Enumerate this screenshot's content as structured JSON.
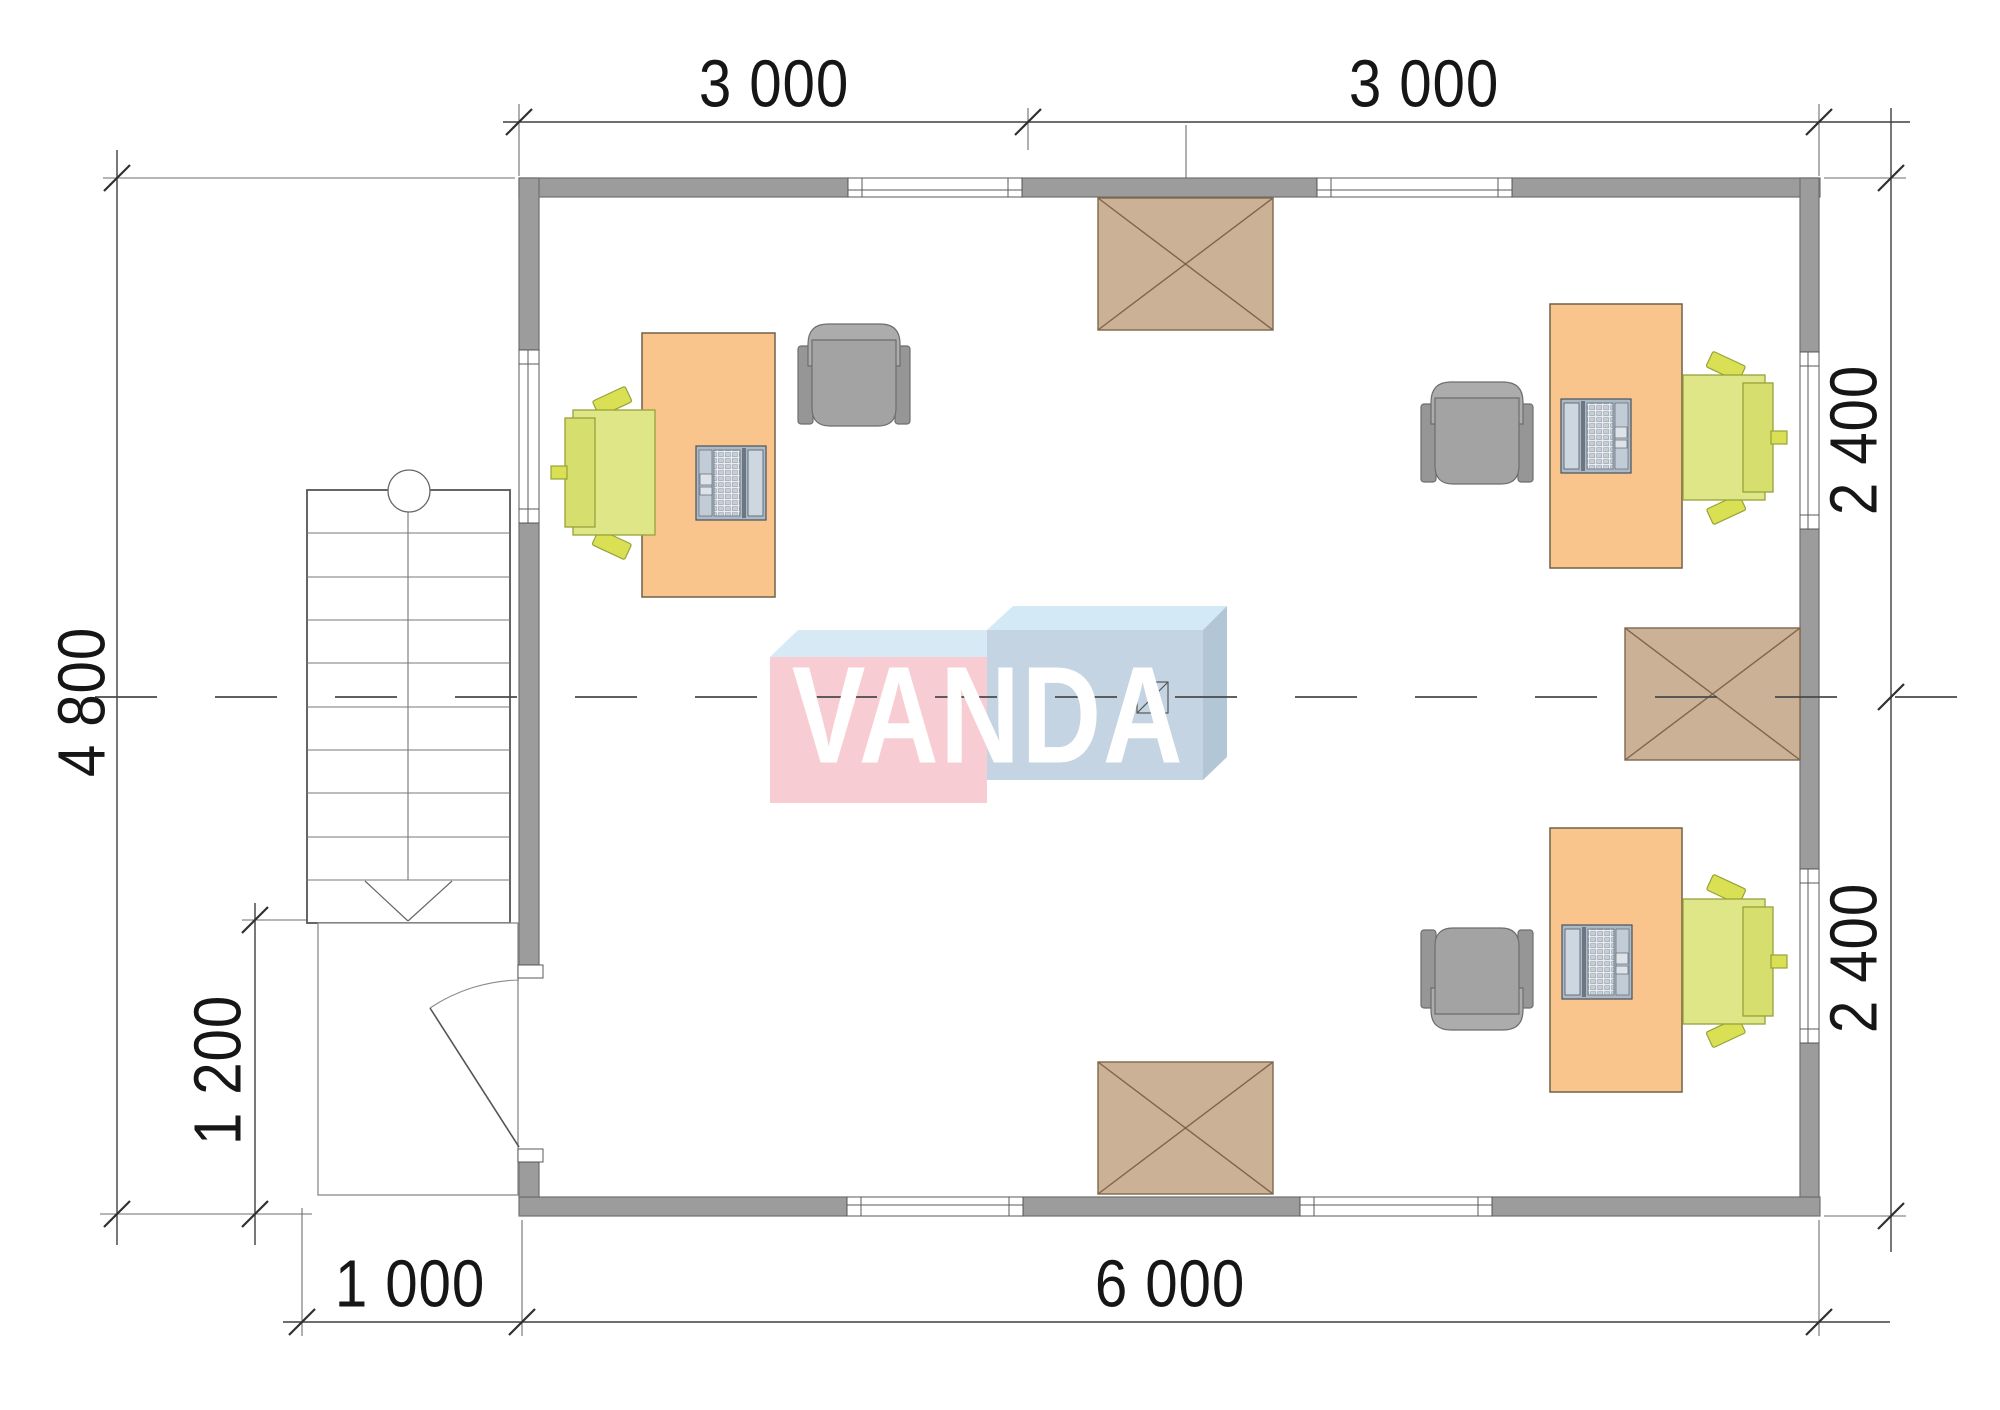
{
  "document": {
    "type": "architectural floor plan",
    "units": "mm"
  },
  "watermark": {
    "text": "VANDA"
  },
  "dimensions": {
    "top": [
      "3 000",
      "3 000"
    ],
    "right": [
      "2 400",
      "2 400"
    ],
    "left_overall": "4 800",
    "porch_height": "1 200",
    "porch_width": "1 000",
    "bottom_overall": "6 000"
  },
  "colors": {
    "wall": "#9c9c9c",
    "wall_outline": "#707070",
    "hatch_block": "#cbb195",
    "hatch_outline": "#80654a",
    "desk": "#f9c58d",
    "green_chair": "#dee688",
    "gray_chair": "#a3a3a3",
    "logo_pink_front": "#f7cdd3",
    "logo_pink_top": "#d7e9f5",
    "logo_blue_front": "#c4d4e3",
    "logo_blue_top": "#d3e9f6",
    "logo_blue_side": "#b3c6d6",
    "dimension_text": "#161616"
  }
}
